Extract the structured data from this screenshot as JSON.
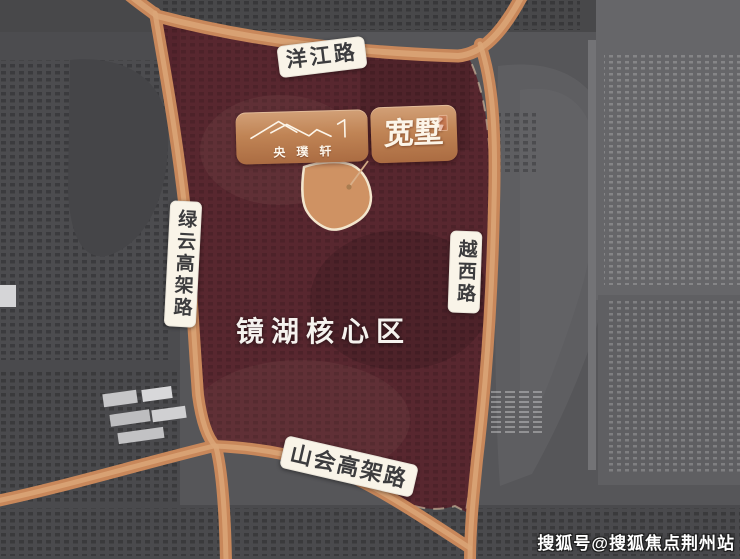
{
  "map": {
    "area_label": "镜湖核心区",
    "roads": {
      "top": "洋江路",
      "left": "绿云高架路",
      "right": "越西路",
      "bottom": "山会高架路"
    }
  },
  "banner": {
    "brand_name": "央璞轩",
    "product_name": "宽墅"
  },
  "watermark": {
    "text": "搜狐号@搜狐焦点荆州站"
  },
  "colors": {
    "road_orange": "#c8875a",
    "road_highlight": "#dba678",
    "region_overlay": "#5a1f28",
    "plot_fill": "#cf9263",
    "plot_border": "#f3e6cd",
    "banner_copper": "#c08455",
    "label_background": "#f9f4e8",
    "label_text": "#3c3c3e",
    "satellite_gray": "#565659"
  }
}
